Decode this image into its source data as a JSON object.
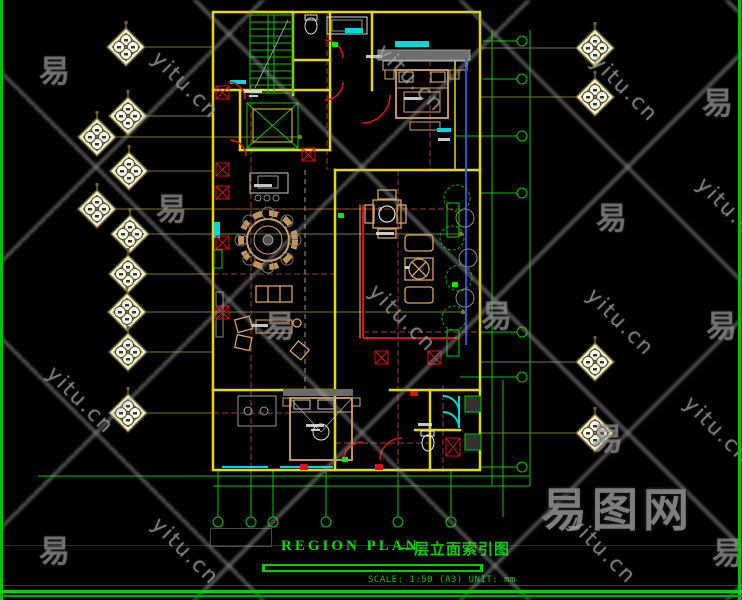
{
  "drawing": {
    "title_en": "REGION PLAN",
    "title_zh": "一层立面索引图",
    "scale_label": "SCALE: 1:50 (A3) UNIT: mm"
  },
  "watermark": {
    "text": "yitu.cn",
    "char": "易",
    "logo": "易图网",
    "yitu_positions": [
      [
        178,
        85
      ],
      [
        403,
        78
      ],
      [
        617,
        88
      ],
      [
        395,
        318
      ],
      [
        613,
        322
      ],
      [
        723,
        211
      ],
      [
        73,
        400
      ],
      [
        178,
        551
      ],
      [
        595,
        550
      ],
      [
        710,
        430
      ]
    ],
    "char_positions": [
      [
        55,
        65
      ],
      [
        172,
        203
      ],
      [
        280,
        320
      ],
      [
        497,
        310
      ],
      [
        718,
        97
      ],
      [
        612,
        212
      ],
      [
        722,
        320
      ],
      [
        608,
        433
      ],
      [
        55,
        545
      ],
      [
        728,
        547
      ]
    ]
  },
  "elevation_symbols": {
    "icon": "diamond-elevation-index-marker",
    "left": [
      {
        "x": 126,
        "y": 47
      },
      {
        "x": 128,
        "y": 116
      },
      {
        "x": 97,
        "y": 137,
        "ext": 300
      },
      {
        "x": 129,
        "y": 171
      },
      {
        "x": 97,
        "y": 209,
        "ext": 380
      },
      {
        "x": 130,
        "y": 234,
        "ext": 461
      },
      {
        "x": 128,
        "y": 274
      },
      {
        "x": 127,
        "y": 312,
        "ext": 463
      },
      {
        "x": 128,
        "y": 352
      },
      {
        "x": 128,
        "y": 413
      }
    ],
    "right": [
      {
        "x": 595,
        "y": 48
      },
      {
        "x": 595,
        "y": 97
      },
      {
        "x": 595,
        "y": 362
      },
      {
        "x": 595,
        "y": 433
      }
    ]
  },
  "colors": {
    "background": "#000000",
    "frame_green": "#00c400",
    "wall_yellow": "#e6d800",
    "grid_green": "#00c800",
    "door_red": "#dd1111",
    "window_cyan": "#00d8d8",
    "furniture_tan": "#d9a35f",
    "accent_blue": "#2a52d8",
    "centerline_red": "#a04040",
    "symbol_cream": "#f2ecce",
    "leader_olive": "#7d7d2a",
    "watermark_gray": "#8a8a8a",
    "title_green": "#00dd00"
  }
}
